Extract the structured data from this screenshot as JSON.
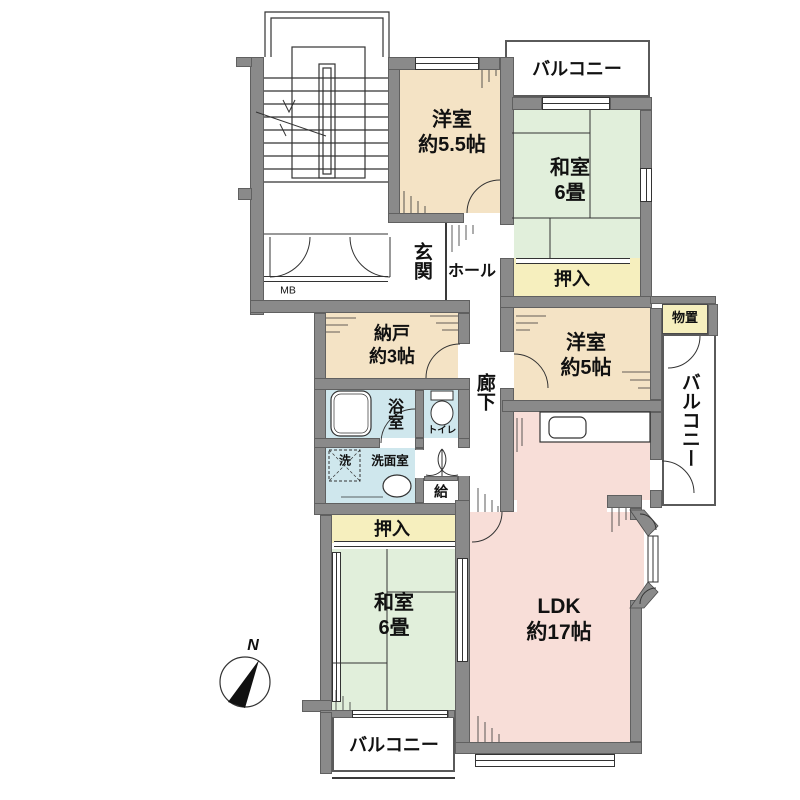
{
  "title": "floor-plan",
  "colors": {
    "wall": "#8a8a8a",
    "western_room": "#f4e3c5",
    "tatami_room": "#e1efdb",
    "closet": "#f6efbe",
    "ldk": "#f8ded8",
    "wet_area": "#cfe7ed",
    "line": "#333333"
  },
  "rooms": {
    "western_55": {
      "name": "洋室",
      "size": "約5.5帖"
    },
    "japanese_top": {
      "name": "和室",
      "size": "6畳"
    },
    "closet_top": "押入",
    "western_5": {
      "name": "洋室",
      "size": "約5帖"
    },
    "nando": {
      "name": "納戸",
      "size": "約3帖"
    },
    "monooki": "物置",
    "genkan": "玄関",
    "hall": "ホール",
    "corridor": "廊下",
    "bath": "浴室",
    "toilet": "トイレ",
    "washroom": "洗面室",
    "washer": "洗",
    "water_supply": "給",
    "closet_bottom": "押入",
    "japanese_bottom": {
      "name": "和室",
      "size": "6畳"
    },
    "ldk": {
      "name": "LDK",
      "size": "約17帖"
    },
    "balcony_top": "バルコニー",
    "balcony_right": "バルコニー",
    "balcony_bottom": "バルコニー",
    "meter_box": "MB"
  },
  "compass": {
    "north": "N"
  }
}
